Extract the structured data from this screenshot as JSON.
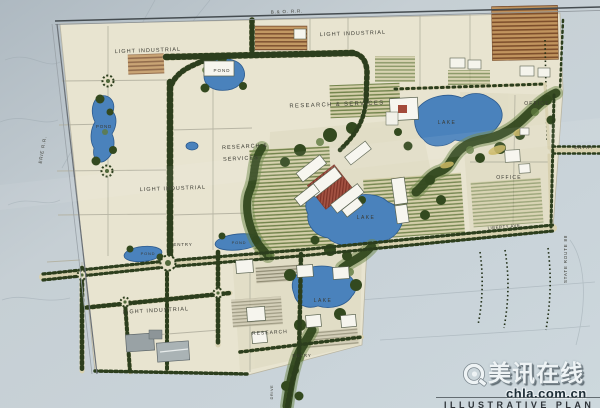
{
  "plan": {
    "title": "ILLUSTRATIVE PLAN",
    "labels": {
      "railroad_top": "B.& O. R.R.",
      "railroad_left": "ERIE R.R.",
      "light_industrial_nw": "LIGHT INDUSTRIAL",
      "light_industrial_ne": "LIGHT INDUSTRIAL",
      "light_industrial_w": "LIGHT INDUSTRIAL",
      "light_industrial_sw": "LIGHT INDUSTRIAL",
      "research_services_n": "RESEARCH & SERVICES",
      "research_services_w1": "RESEARCH &",
      "research_services_w2": "SERVICES",
      "research_s": "RESEARCH",
      "office_ne": "OFFICE",
      "office_e": "OFFICE",
      "lake_ne": "LAKE",
      "lake_center": "LAKE",
      "lake_s": "LAKE",
      "pond_n": "POND",
      "pond_w": "POND",
      "pond_sw": "POND",
      "pond_entry": "POND",
      "entry_e": "ENTRY",
      "entry_w": "ENTRY",
      "entry_s": "ENTRY",
      "liberty_ave": "LIBERTY AVE.",
      "state_route": "STATE ROUTE 88",
      "drive_s": "DRIVE"
    }
  },
  "watermark": {
    "brand": "美讯在线",
    "domain": "chla.com.cn"
  },
  "colors": {
    "paper": "#c5cfd4",
    "plan_cream": "#e8e4d0",
    "road_tan": "#d8d1b0",
    "tree_green": "#2c3e1d",
    "forest_green": "#33491f",
    "lake_blue": "#4a82bc",
    "plaza_red": "#a35242"
  }
}
